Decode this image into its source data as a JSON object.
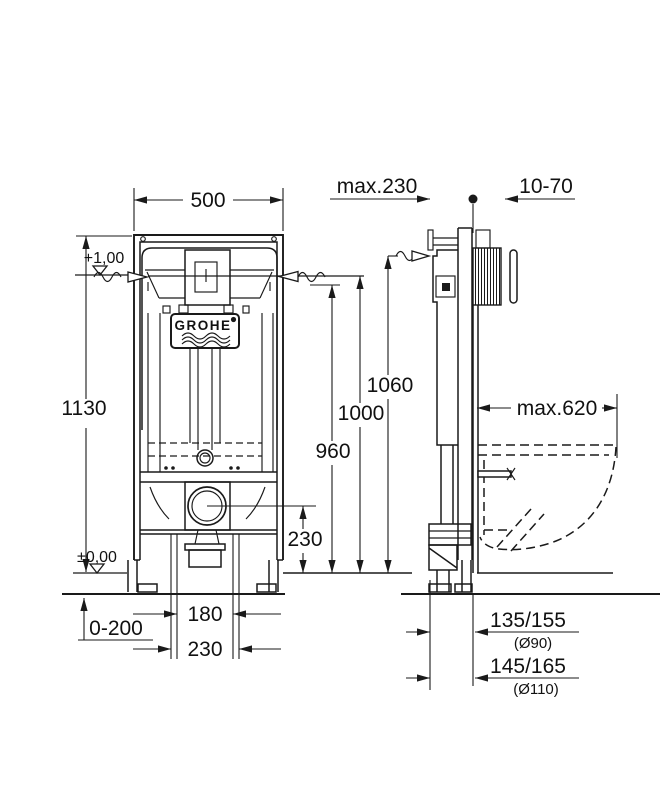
{
  "drawing": {
    "brand": "GROHE",
    "front_view": {
      "width": "500",
      "total_height": "1130",
      "level_top": "+1,00",
      "level_floor": "±0,00",
      "floor_buildup": "0-200",
      "outlet_height": "230",
      "height_960": "960",
      "height_1000": "1000",
      "height_1060": "1060",
      "fixing_spacing": "180",
      "pipe_spacing": "230"
    },
    "side_view": {
      "frame_depth": "max.230",
      "plate_adjust": "10-70",
      "bowl_depth": "max.620",
      "drain_90": "135/155",
      "drain_90_dia": "(Ø90)",
      "drain_110": "145/165",
      "drain_110_dia": "(Ø110)"
    }
  }
}
